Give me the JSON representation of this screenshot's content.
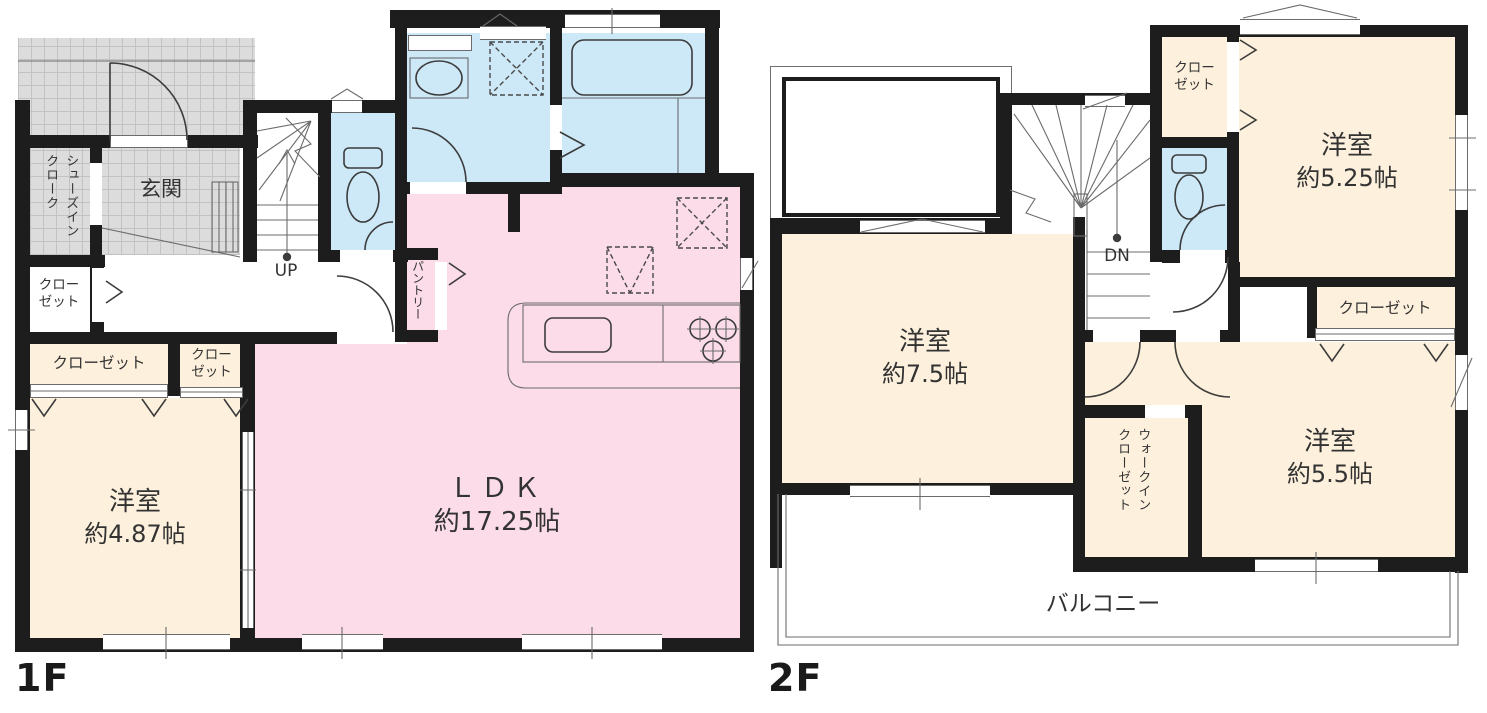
{
  "colors": {
    "wall": "#1d1d1d",
    "ldk_pink": "#fbdce8",
    "room_beige": "#fdf0dc",
    "wet_area_blue": "#cde8f7",
    "tile_gray": "#dcdcdc"
  },
  "floor1": {
    "label": "1F",
    "rooms": {
      "genkan": {
        "label": "玄関"
      },
      "shoes_cloak": {
        "lines": [
          "シューズイン",
          "クローク"
        ]
      },
      "hall_closet": {
        "lines": [
          "クロー",
          "ゼット"
        ]
      },
      "stairs": {
        "direction": "UP"
      },
      "pantry": {
        "label": "パントリー"
      },
      "ldk": {
        "label": "ＬＤＫ",
        "size": "約17.25帖"
      },
      "closet_wide": {
        "label": "クローゼット"
      },
      "closet_small": {
        "lines": [
          "クロー",
          "ゼット"
        ]
      },
      "bedroom": {
        "label": "洋室",
        "size": "約4.87帖"
      }
    }
  },
  "floor2": {
    "label": "2F",
    "rooms": {
      "stairs": {
        "direction": "DN"
      },
      "hall_closet": {
        "lines": [
          "クロー",
          "ゼット"
        ]
      },
      "bedroom_ne": {
        "label": "洋室",
        "size": "約5.25帖"
      },
      "closet_ne": {
        "label": "クローゼット"
      },
      "bedroom_w": {
        "label": "洋室",
        "size": "約7.5帖"
      },
      "walk_in_closet": {
        "lines": [
          "ウォークイン",
          "クローゼット"
        ]
      },
      "bedroom_se": {
        "label": "洋室",
        "size": "約5.5帖"
      },
      "balcony": {
        "label": "バルコニー"
      }
    }
  }
}
